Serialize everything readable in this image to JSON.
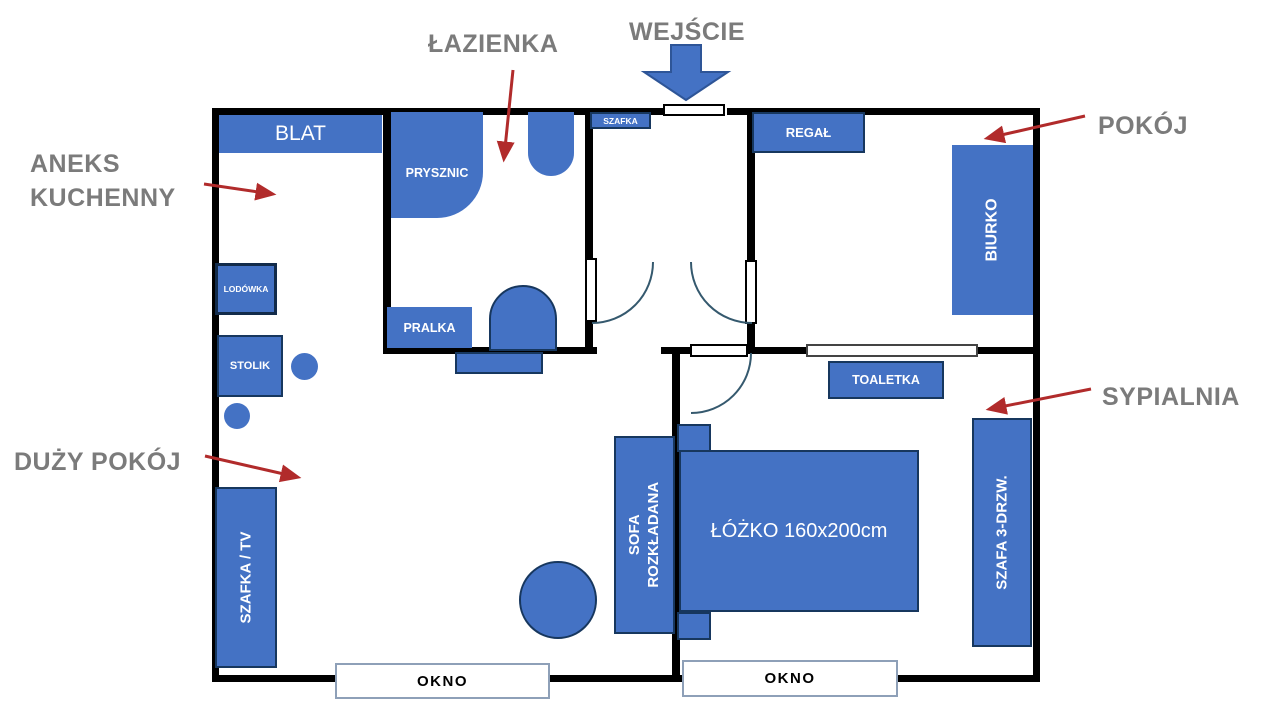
{
  "annotations": {
    "lazienka": "ŁAZIENKA",
    "wejscie": "WEJŚCIE",
    "pokoj": "POKÓJ",
    "aneks_line1": "ANEKS",
    "aneks_line2": "KUCHENNY",
    "duzy_pokoj": "DUŻY POKÓJ",
    "sypialnia": "SYPIALNIA"
  },
  "furniture": {
    "blat": "BLAT",
    "szafka_hall": "SZAFKA",
    "regal": "REGAŁ",
    "biurko": "BIURKO",
    "prysznic": "PRYSZNIC",
    "pralka": "PRALKA",
    "lodowka": "LODÓWKA",
    "stolik": "STOLIK",
    "toaletka": "TOALETKA",
    "szafka_tv": "SZAFKA / TV",
    "sofa_line1": "SOFA",
    "sofa_line2": "ROZKŁADANA",
    "lozko": "ŁÓŻKO 160x200cm",
    "szafa": "SZAFA 3-DRZW."
  },
  "windows": {
    "left": "OKNO",
    "right": "OKNO"
  },
  "colors": {
    "furniture_blue": "#4472C4",
    "furniture_border": "#17375E",
    "wall_black": "#000000",
    "annotation_gray": "#7B7B7B",
    "arrow_red": "#B12B2B",
    "door_arc_teal": "#35596E",
    "window_border": "#8EA0B8"
  }
}
